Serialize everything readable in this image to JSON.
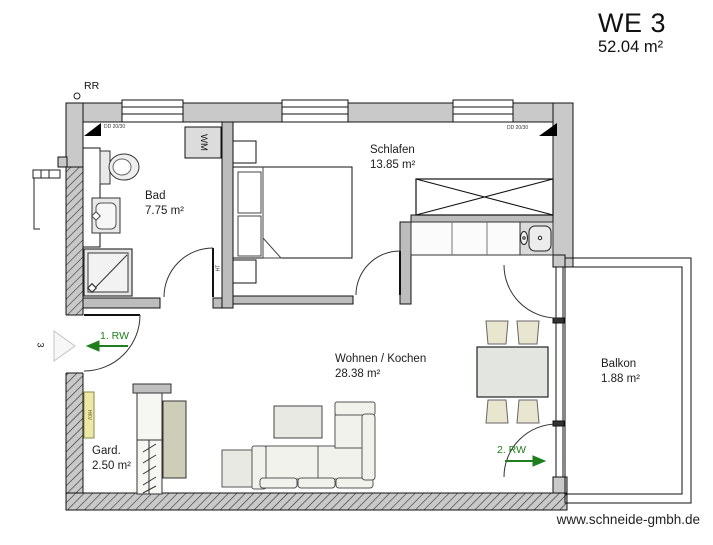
{
  "header": {
    "title": "WE 3",
    "area": "52.04 m²"
  },
  "footer": {
    "website": "www.schneide-gmbh.de"
  },
  "rooms": {
    "bad": {
      "name": "Bad",
      "area": "7.75 m²"
    },
    "schlafen": {
      "name": "Schlafen",
      "area": "13.85 m²"
    },
    "wohnen": {
      "name": "Wohnen / Kochen",
      "area": "28.38 m²"
    },
    "balkon": {
      "name": "Balkon",
      "area": "1.88 m²"
    },
    "gard": {
      "name": "Gard.",
      "area": "2.50 m²"
    }
  },
  "annotations": {
    "rainwater_pipe": "RR",
    "dd_left": "DD 20/30",
    "dd_right": "DD 20/30",
    "washing_machine": "WM",
    "door_label": "HT",
    "heating_distributor": "HKV",
    "escape_route_1": "1. RW",
    "escape_route_2": "2. RW",
    "entrance_number": "3"
  },
  "colors": {
    "escape_green": "#1f7f1f",
    "wall_gray": "#c9c9c9",
    "interior_wall_gray": "#bdbdbd",
    "furniture_beige": "#e9e6cf",
    "hkv_yellow": "#ece9a6"
  }
}
